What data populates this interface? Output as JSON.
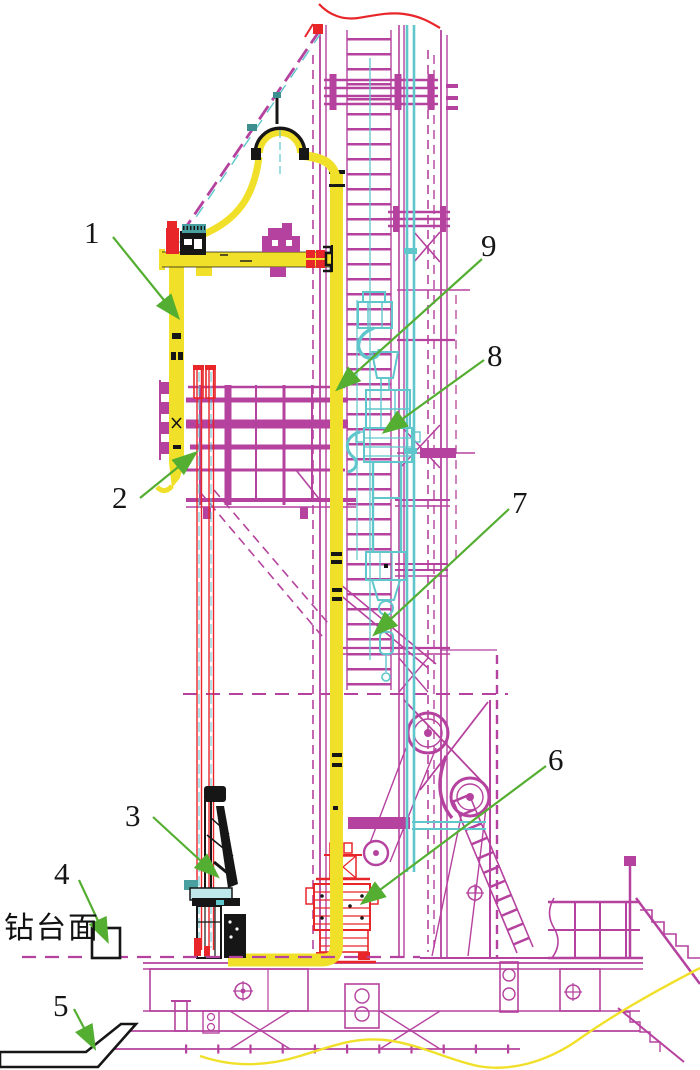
{
  "figure": {
    "type": "engineering-diagram",
    "subject": "drilling-rig-mast-side-view",
    "callouts": {
      "c1": "1",
      "c2": "2",
      "c3": "3",
      "c4": "4",
      "c5": "5",
      "c6": "6",
      "c7": "7",
      "c8": "8",
      "c9": "9"
    },
    "text_labels": {
      "drill_floor": "钻台面"
    },
    "colors": {
      "structure_magenta": "#b5429e",
      "hose_yellow": "#f1e02a",
      "equipment_cyan": "#5fc6cc",
      "accent_red": "#e8262a",
      "arrow_green": "#54ae32",
      "outline_black": "#161616",
      "background": "#ffffff"
    }
  }
}
